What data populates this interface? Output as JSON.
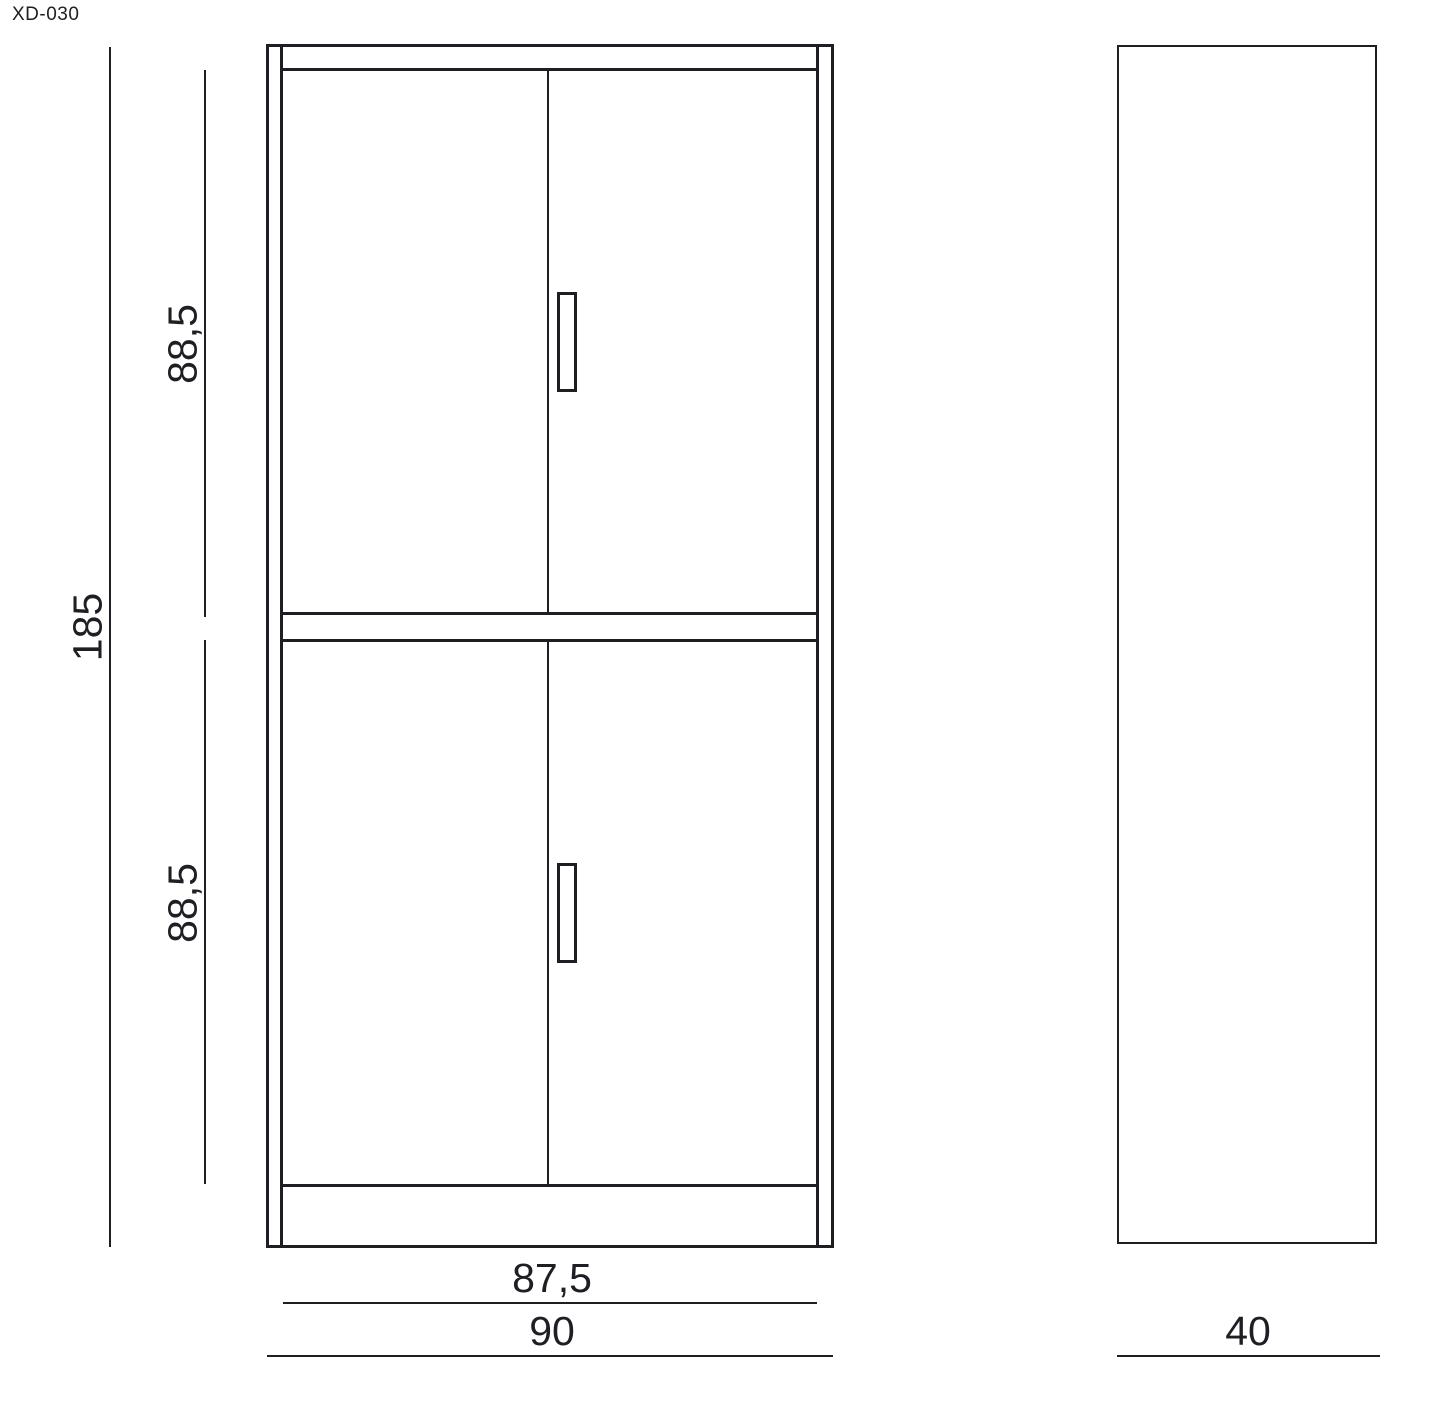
{
  "drawing": {
    "code": "XD-030"
  },
  "colors": {
    "line": "#1e1e24",
    "background": "#ffffff"
  },
  "dimensions": {
    "total_height": "185",
    "upper_door_height": "88,5",
    "lower_door_height": "88,5",
    "door_span_width": "87,5",
    "total_width": "90",
    "depth": "40"
  }
}
